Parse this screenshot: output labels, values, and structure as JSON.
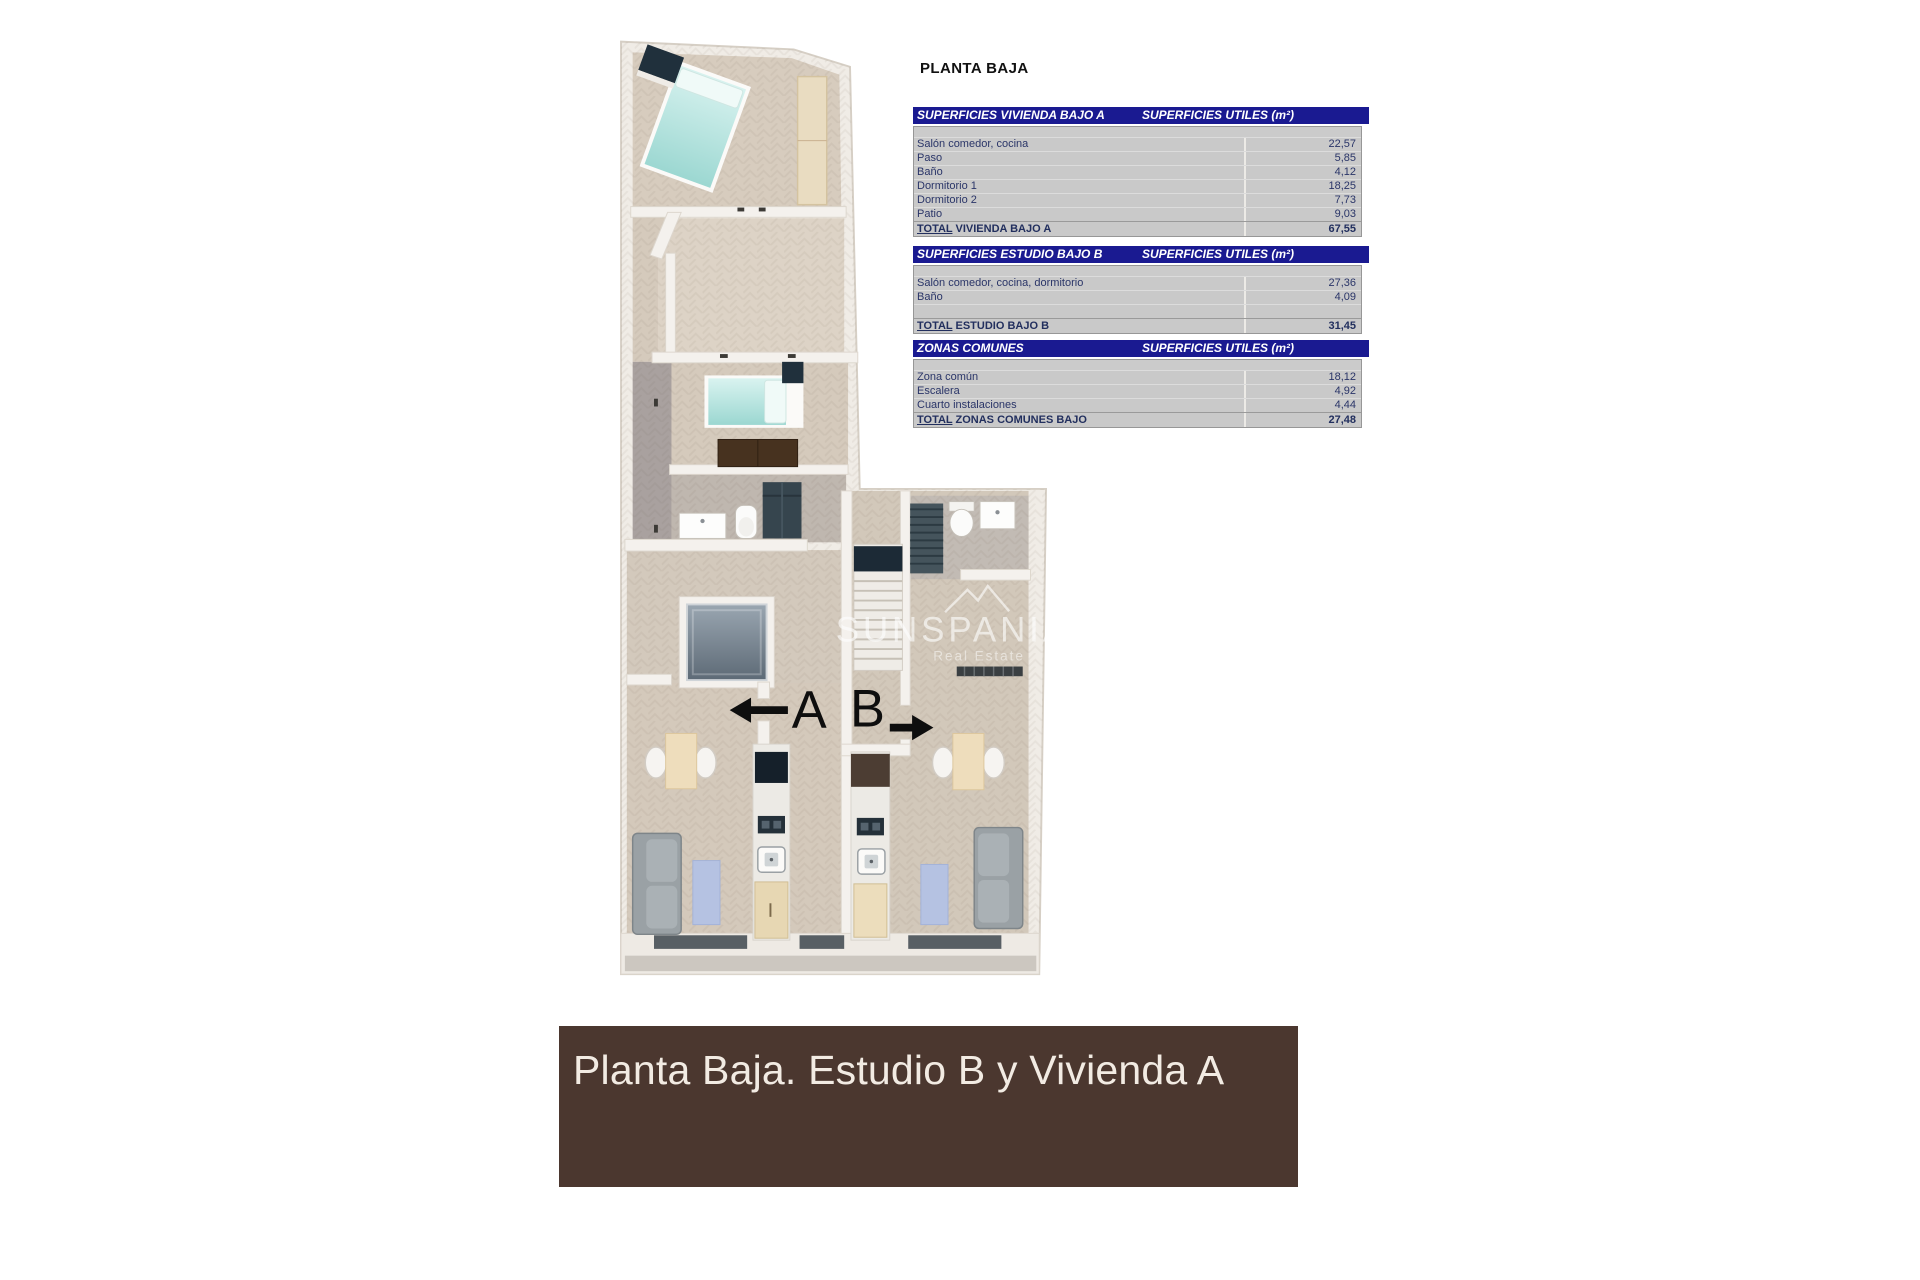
{
  "page_title": "PLANTA BAJA",
  "tables": [
    {
      "title": "SUPERFICIES VIVIENDA BAJO A",
      "units_header": "SUPERFICIES UTILES  (m²)",
      "rows": [
        {
          "label": "Salón comedor, cocina",
          "value": "22,57"
        },
        {
          "label": "Paso",
          "value": "5,85"
        },
        {
          "label": "Baño",
          "value": "4,12"
        },
        {
          "label": "Dormitorio 1",
          "value": "18,25"
        },
        {
          "label": "Dormitorio 2",
          "value": "7,73"
        },
        {
          "label": "Patio",
          "value": "9,03"
        }
      ],
      "total": {
        "prefix": "TOTAL",
        "suffix": " VIVIENDA BAJO A",
        "value": "67,55"
      }
    },
    {
      "title": "SUPERFICIES ESTUDIO BAJO B",
      "units_header": "SUPERFICIES UTILES  (m²)",
      "rows": [
        {
          "label": "Salón comedor, cocina, dormitorio",
          "value": "27,36"
        },
        {
          "label": "Baño",
          "value": "4,09"
        },
        {
          "label": "",
          "value": ""
        }
      ],
      "total": {
        "prefix": "TOTAL",
        "suffix": " ESTUDIO BAJO B",
        "value": "31,45"
      }
    },
    {
      "title": "ZONAS COMUNES",
      "units_header": "SUPERFICIES UTILES  (m²)",
      "rows": [
        {
          "label": "Zona común",
          "value": "18,12"
        },
        {
          "label": "Escalera",
          "value": "4,92"
        },
        {
          "label": "Cuarto instalaciones",
          "value": "4,44"
        }
      ],
      "total": {
        "prefix": "TOTAL",
        "suffix": " ZONAS COMUNES BAJO",
        "value": "27,48"
      }
    }
  ],
  "floor_plan": {
    "unit_a_label": "A",
    "unit_b_label": "B",
    "watermark": {
      "brand": "SUNSPANIA",
      "tagline": "Real Estate"
    }
  },
  "banner": {
    "text": "Planta Baja. Estudio B y Vivienda A"
  },
  "icons": {
    "arrow_left": "left-arrow-to-unit-a",
    "arrow_right": "right-arrow-to-unit-b",
    "logo": "mountain-logo"
  },
  "colors": {
    "table_header_bg": "#1a1a91",
    "table_row_bg": "#c9c9c9",
    "table_text": "#2a3568",
    "banner_bg": "#4b372f",
    "banner_text": "#f2ebe3",
    "floor_beige": "#d7ccbe",
    "corridor_grey": "#a9a19f",
    "wall_white": "#f3f0ec",
    "bed_teal": "#a8ded9",
    "patio_slate": "#8b96a1",
    "dark_navy": "#1c2a36",
    "wood_light": "#e9dcc1",
    "wood_dark": "#47321f"
  }
}
